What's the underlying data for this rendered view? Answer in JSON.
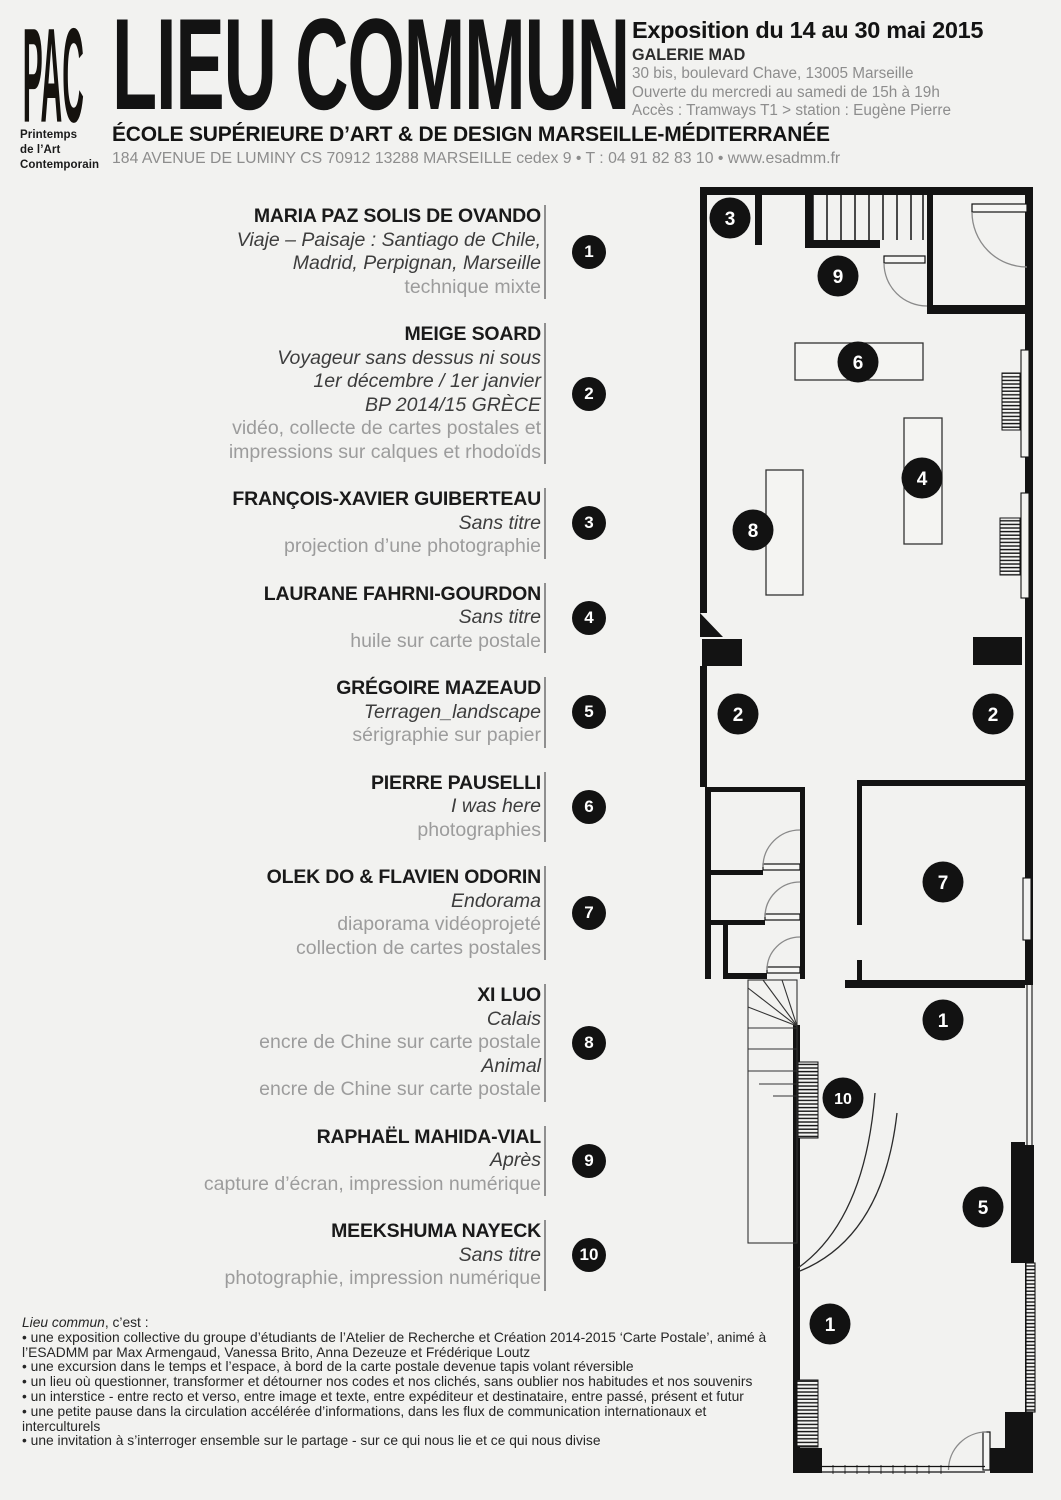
{
  "colors": {
    "background": "#f2f2f0",
    "ink": "#131313",
    "gray_text": "#8d8d8d",
    "medium_text": "#9c9c9c"
  },
  "logo": {
    "letters": "PAC",
    "subtitle_lines": [
      "Printemps",
      "de l’Art",
      "Contemporain"
    ]
  },
  "header": {
    "title": "LIEU COMMUN",
    "expo_title": "Exposition du 14 au 30 mai 2015",
    "venue": "GALERIE MAD",
    "venue_lines": [
      "30 bis, boulevard Chave, 13005 Marseille",
      "Ouverte du mercredi au samedi de 15h à 19h",
      "Accès : Tramways T1 > station : Eugène Pierre"
    ],
    "school": "ÉCOLE SUPÉRIEURE D’ART & DE DESIGN MARSEILLE-MÉDITERRANÉE",
    "school_address": "184 AVENUE DE LUMINY CS 70912 13288 MARSEILLE cedex 9 • T : 04 91 82 83 10 • www.esadmm.fr"
  },
  "artists": [
    {
      "num": "1",
      "name": "MARIA PAZ SOLIS DE OVANDO",
      "lines": [
        {
          "kind": "title",
          "text": "Viaje – Paisaje : Santiago de Chile,"
        },
        {
          "kind": "title",
          "text": "Madrid, Perpignan, Marseille"
        },
        {
          "kind": "medium",
          "text": "technique mixte"
        }
      ]
    },
    {
      "num": "2",
      "name": "MEIGE SOARD",
      "lines": [
        {
          "kind": "title",
          "text": "Voyageur sans dessus ni sous"
        },
        {
          "kind": "title",
          "text": "1er décembre / 1er janvier"
        },
        {
          "kind": "title",
          "text": "BP 2014/15 GRÈCE"
        },
        {
          "kind": "medium",
          "text": "vidéo, collecte de cartes postales et"
        },
        {
          "kind": "medium",
          "text": "impressions sur calques et rhodoïds"
        }
      ]
    },
    {
      "num": "3",
      "name": "FRANÇOIS-XAVIER GUIBERTEAU",
      "lines": [
        {
          "kind": "title",
          "text": "Sans titre"
        },
        {
          "kind": "medium",
          "text": "projection d’une photographie"
        }
      ]
    },
    {
      "num": "4",
      "name": "LAURANE FAHRNI-GOURDON",
      "lines": [
        {
          "kind": "title",
          "text": "Sans titre"
        },
        {
          "kind": "medium",
          "text": "huile sur carte postale"
        }
      ]
    },
    {
      "num": "5",
      "name": "GRÉGOIRE MAZEAUD",
      "lines": [
        {
          "kind": "title",
          "text": "Terragen_landscape"
        },
        {
          "kind": "medium",
          "text": "sérigraphie sur papier"
        }
      ]
    },
    {
      "num": "6",
      "name": "PIERRE PAUSELLI",
      "lines": [
        {
          "kind": "title",
          "text": "I was here"
        },
        {
          "kind": "medium",
          "text": "photographies"
        }
      ]
    },
    {
      "num": "7",
      "name": "OLEK DO & FLAVIEN ODORIN",
      "lines": [
        {
          "kind": "title",
          "text": "Endorama"
        },
        {
          "kind": "medium",
          "text": "diaporama vidéoprojeté"
        },
        {
          "kind": "medium",
          "text": "collection de cartes postales"
        }
      ]
    },
    {
      "num": "8",
      "name": "XI LUO",
      "lines": [
        {
          "kind": "title",
          "text": "Calais"
        },
        {
          "kind": "medium",
          "text": "encre de Chine sur carte postale"
        },
        {
          "kind": "title",
          "text": "Animal"
        },
        {
          "kind": "medium",
          "text": "encre de Chine sur carte postale"
        }
      ]
    },
    {
      "num": "9",
      "name": "RAPHAËL MAHIDA-VIAL",
      "lines": [
        {
          "kind": "title",
          "text": "Après"
        },
        {
          "kind": "medium",
          "text": "capture d’écran, impression numérique"
        }
      ]
    },
    {
      "num": "10",
      "name": "MEEKSHUMA NAYECK",
      "lines": [
        {
          "kind": "title",
          "text": "Sans titre"
        },
        {
          "kind": "medium",
          "text": "photographie, impression numérique"
        }
      ]
    }
  ],
  "plan_markers": [
    {
      "num": "3",
      "x": 35,
      "y": 33
    },
    {
      "num": "9",
      "x": 143,
      "y": 91
    },
    {
      "num": "6",
      "x": 163,
      "y": 177
    },
    {
      "num": "4",
      "x": 227,
      "y": 293
    },
    {
      "num": "8",
      "x": 58,
      "y": 345
    },
    {
      "num": "2",
      "x": 43,
      "y": 529
    },
    {
      "num": "2",
      "x": 298,
      "y": 529
    },
    {
      "num": "7",
      "x": 248,
      "y": 697
    },
    {
      "num": "1",
      "x": 248,
      "y": 835
    },
    {
      "num": "10",
      "x": 148,
      "y": 913
    },
    {
      "num": "5",
      "x": 288,
      "y": 1022
    },
    {
      "num": "1",
      "x": 135,
      "y": 1139
    }
  ],
  "about": {
    "lead_italic": "Lieu commun",
    "lead_rest": ", c’est :",
    "bullets": [
      "• une exposition collective du groupe d’étudiants de l’Atelier de Recherche et Création 2014-2015 ‘Carte Postale’, animé à l’ESADMM par Max Armengaud, Vanessa Brito, Anna Dezeuze et Frédérique Loutz",
      "• une excursion dans le temps et l’espace, à bord de la carte postale devenue tapis volant réversible",
      "• un lieu où questionner, transformer et détourner nos codes et nos clichés, sans oublier nos habitudes et nos souvenirs",
      "• un interstice - entre recto et verso, entre image et texte, entre expéditeur et destinataire, entre passé, présent et futur",
      "• une petite pause dans la circulation accélérée d’informations, dans les flux de communication internationaux et interculturels",
      "• une invitation à s’interroger ensemble sur le partage - sur ce qui nous lie et ce qui nous divise"
    ]
  }
}
